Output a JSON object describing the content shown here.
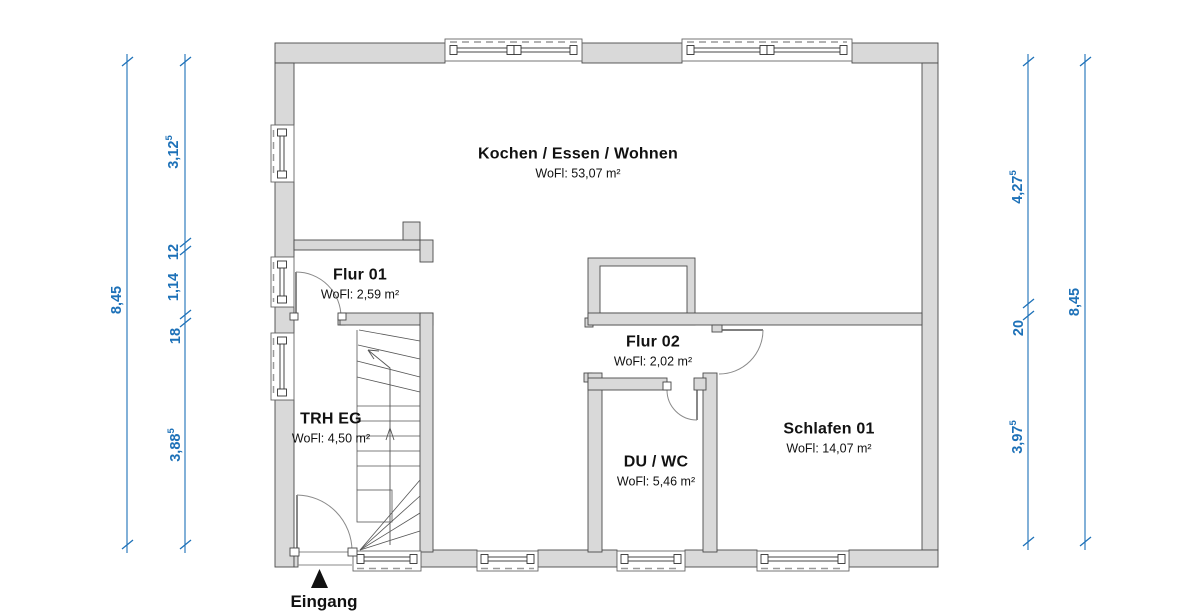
{
  "title": "Grundriss EG",
  "rooms": [
    {
      "id": "kochen",
      "name": "Kochen / Essen / Wohnen",
      "area": "WoFl: 53,07 m²"
    },
    {
      "id": "flur01",
      "name": "Flur 01",
      "area": "WoFl: 2,59 m²"
    },
    {
      "id": "flur02",
      "name": "Flur 02",
      "area": "WoFl: 2,02 m²"
    },
    {
      "id": "trh-eg",
      "name": "TRH EG",
      "area": "WoFl: 4,50 m²"
    },
    {
      "id": "du-wc",
      "name": "DU / WC",
      "area": "WoFl: 5,46 m²"
    },
    {
      "id": "schlafen",
      "name": "Schlafen 01",
      "area": "WoFl: 14,07 m²"
    }
  ],
  "entrance": {
    "label": "Eingang"
  },
  "dimensions": {
    "left_outer": {
      "value": "8,45",
      "sup": ""
    },
    "left_chain": [
      {
        "value": "3,12",
        "sup": "5"
      },
      {
        "value": "12",
        "sup": ""
      },
      {
        "value": "1,14",
        "sup": ""
      },
      {
        "value": "18",
        "sup": ""
      },
      {
        "value": "3,88",
        "sup": "5"
      }
    ],
    "right_chain": [
      {
        "value": "4,27",
        "sup": "5"
      },
      {
        "value": "20",
        "sup": ""
      },
      {
        "value": "3,97",
        "sup": "5"
      }
    ],
    "right_outer": {
      "value": "8,45",
      "sup": ""
    }
  },
  "colors": {
    "dimension_blue": "#1d71b8",
    "wall_fill": "#d9d9d9",
    "wall_line": "#4a4a4a"
  }
}
